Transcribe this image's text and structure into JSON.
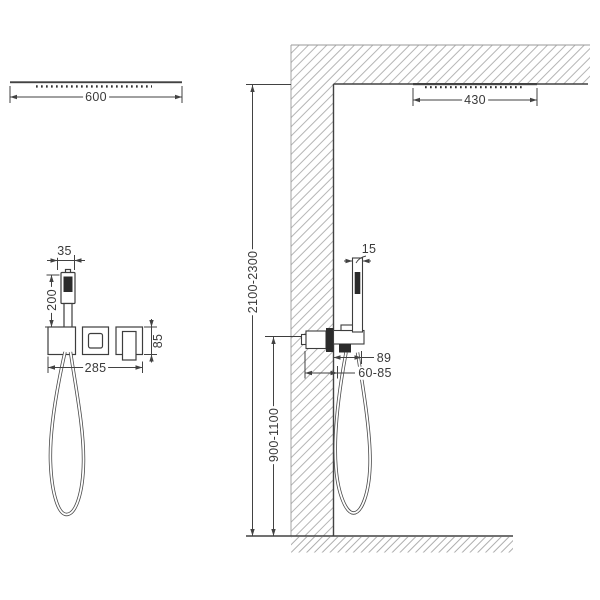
{
  "diagram": {
    "title": "Concealed shower system installation drawing",
    "views": {
      "left": "overhead shower head and mixer trim — front view",
      "right": "wall section with ceiling shower, mixer and hand shower — side view"
    },
    "line_color": "#424242",
    "hatch_color": "#a3a3a3"
  },
  "dimensions": {
    "overhead_shower_width": "600",
    "ceiling_shower_width": "430",
    "handshower_width": "35",
    "handshower_length": "200",
    "mixer_trim_width": "285",
    "mixer_trim_height": "85",
    "handshower_depth": "15",
    "wall_offset": "89",
    "embed_depth_range": "60-85",
    "ceiling_height_range": "2100-2300",
    "mixer_height_range": "900-1100"
  }
}
